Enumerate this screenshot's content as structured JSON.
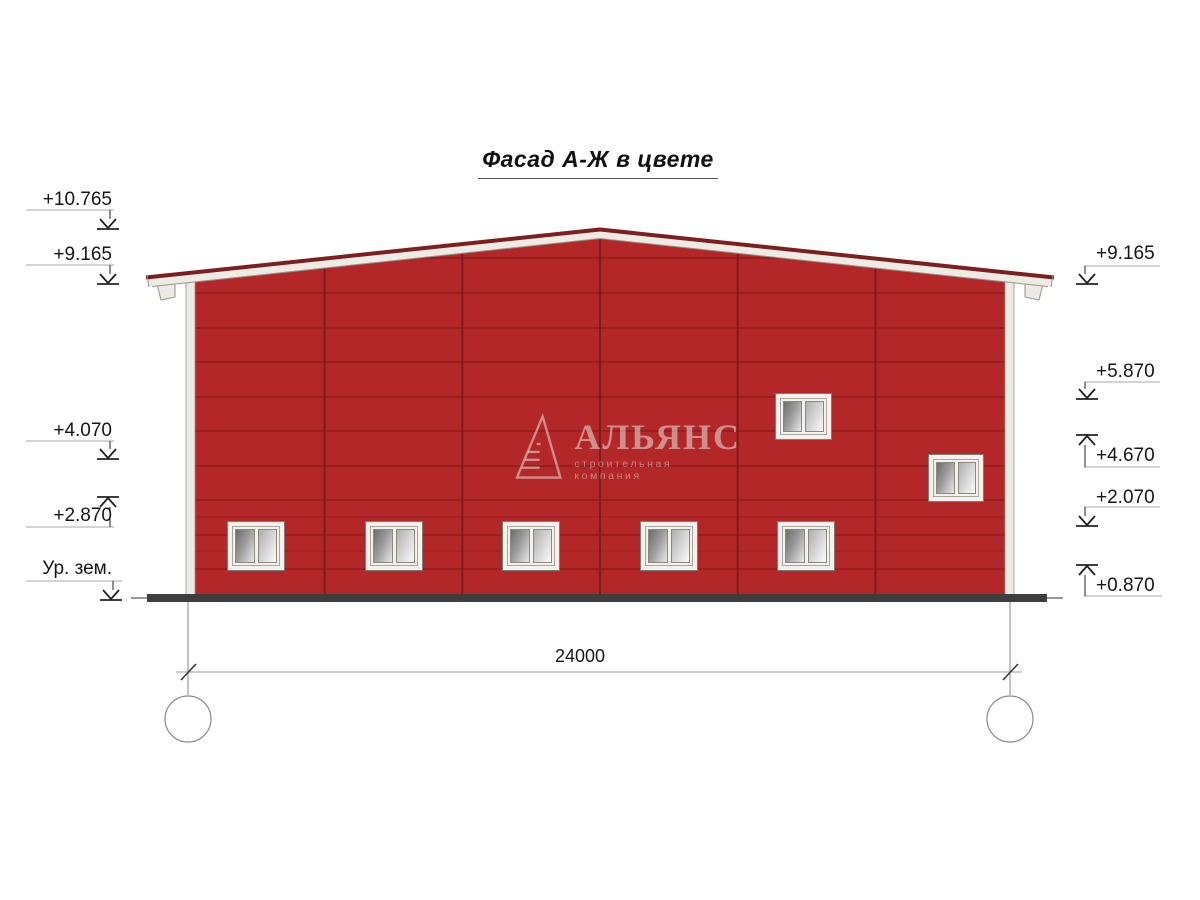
{
  "title": "Фасад А-Ж в цвете",
  "watermark": {
    "name": "АЛЬЯНС",
    "tagline": "строительная компания"
  },
  "levels_left": [
    {
      "label": "+10.765"
    },
    {
      "label": "+9.165"
    },
    {
      "label": "+4.070"
    },
    {
      "label": "+2.870"
    },
    {
      "label": "Ур. зем."
    }
  ],
  "levels_right": [
    {
      "label": "+9.165"
    },
    {
      "label": "+5.870"
    },
    {
      "label": "+4.670"
    },
    {
      "label": "+2.070"
    },
    {
      "label": "+0.870"
    }
  ],
  "dimension": {
    "total": "24000"
  },
  "axes": {
    "left": "А",
    "right": "Ж"
  },
  "colors": {
    "wall_red": "#b32728",
    "seam_red": "#7d1c1d",
    "fascia": "#edebe5",
    "ridge": "#7e1f1f",
    "ground": "#3e3e3e"
  }
}
